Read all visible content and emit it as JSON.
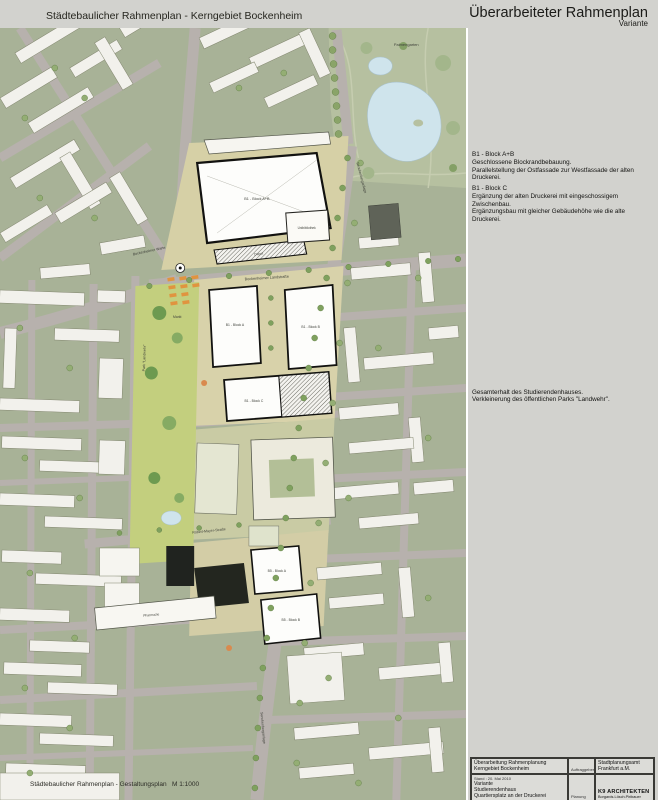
{
  "header": {
    "left_title": "Städtebaulicher Rahmenplan - Kerngebiet Bockenheim",
    "right_title": "Überarbeiteter Rahmenplan",
    "right_subtitle": "Variante"
  },
  "panel": {
    "annotations": {
      "b1_ab_title": "B1 - Block A+B",
      "b1_ab_line1": "Geschlossene Blockrandbebauung.",
      "b1_ab_line2": "Parallelstellung der Ostfassade zur Westfassade der alten Druckerei.",
      "b1_c_title": "B1 - Block C",
      "b1_c_line1": "Ergänzung der alten Druckerei mit eingeschossigem Zwischenbau.",
      "b1_c_line2": "Ergänzungsbau mit gleicher Gebäudehöhe wie die alte Druckerei.",
      "mid_line1": "Gesamterhalt des Studierendenhauses.",
      "mid_line2": "Verkleinerung des öffentlichen Parks \"Landwehr\"."
    }
  },
  "map": {
    "labels": {
      "palmengarten": "Palmengarten",
      "bockenheimer_warte": "Bockenheimer Warte",
      "markt": "Markt",
      "bockenheimer_landstrasse": "Bockenheimer Landstraße",
      "senckenberganlage_top": "Senckenberganlage",
      "senckenberganlage_bottom": "Senckenberganlage",
      "robert_mayer_strasse": "Robert-Mayer-Straße",
      "park_landwehr": "Park \"Landwehr\"",
      "depot": "Depot",
      "unibibliothek": "Unibibliothek",
      "pharmazie": "Pharmazie",
      "b1_block_ab": "B1 - Block A+B",
      "b1_block_a": "B1 - Block A",
      "b1_block_b": "B1 - Block B",
      "b1_block_c": "B1 - Block C",
      "b5_block_a": "B5 - Block A",
      "b5_block_b": "B5 - Block B"
    },
    "footer": {
      "label": "Städtebaulicher Rahmenplan - Gestaltungsplan",
      "scale": "M 1:1000"
    }
  },
  "titleblock": {
    "project_line1": "Überarbeitung Rahmenplanung",
    "project_line2": "Kerngebiet Bockenheim",
    "client_label": "Auftraggeber:",
    "client_line1": "Stadtplanungsamt",
    "client_line2": "Frankfurt a.M.",
    "stand": "Stand : 20. Mai 2010",
    "variant_line1": "Variante",
    "variant_line2": "Studierendenhaus",
    "variant_line3": "Quartiersplatz an der Druckerei",
    "planner_label": "Planung",
    "planner_line1": "K9 ARCHITEKTEN",
    "planner_line2": "Borgards.Lösch.Piribauer"
  },
  "colors": {
    "panel_bg": "#d2d2ce",
    "road_gray": "#b7b1ad",
    "block_green": "#a8b297",
    "park_green": "#b6c0a0",
    "lawn_green": "#c3cf7e",
    "pond_blue": "#cfe4ec",
    "plaza_tan": "#d8d2aa",
    "accent_orange": "#e0943f",
    "building_dark": "#20231f"
  }
}
